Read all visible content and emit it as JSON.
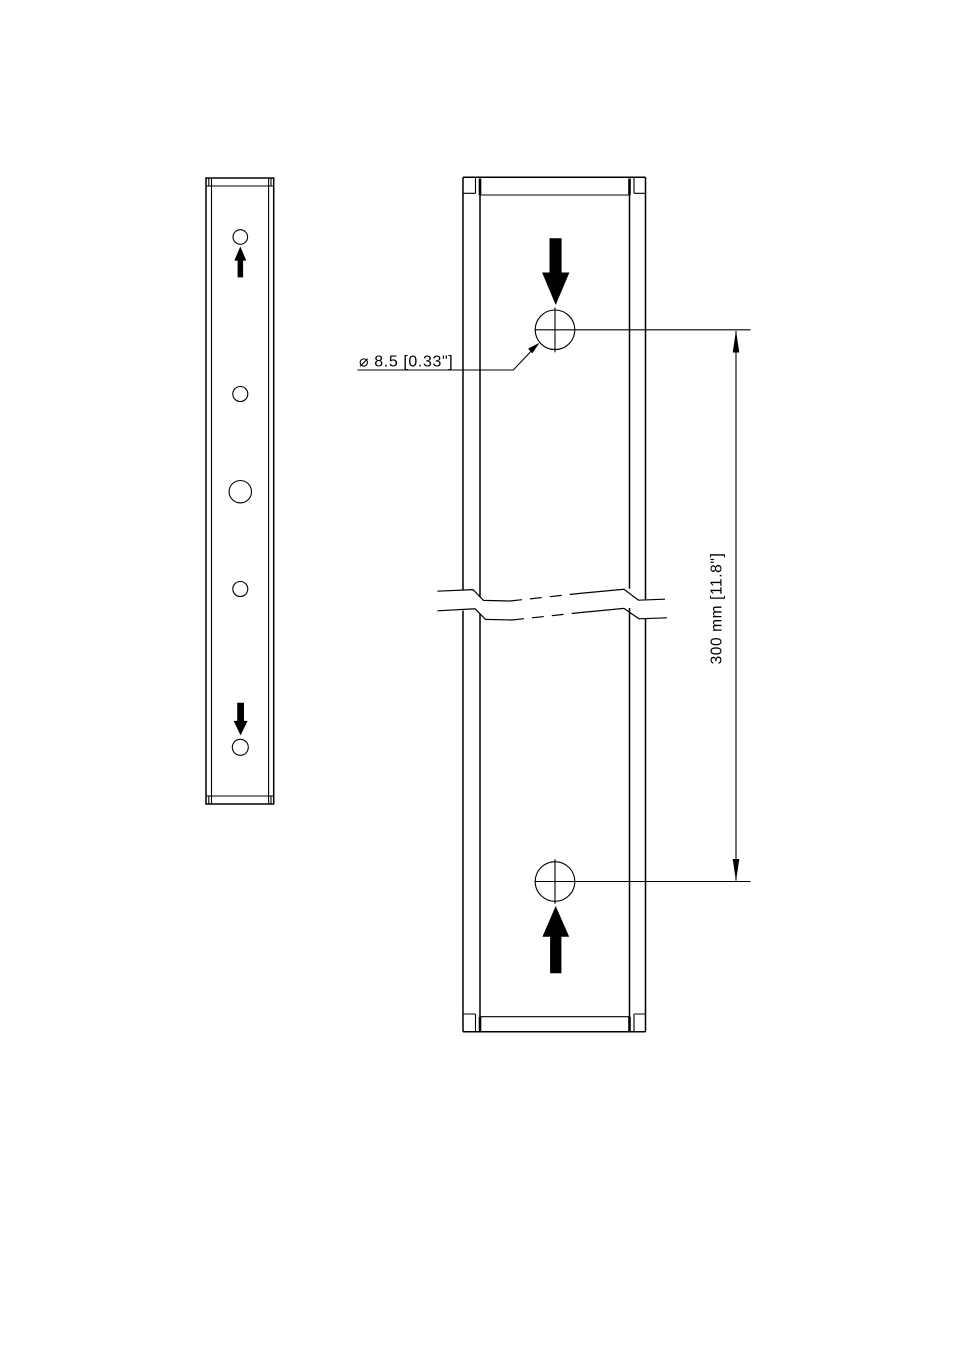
{
  "drawing": {
    "colors": {
      "background": "#ffffff",
      "line": "#000000"
    },
    "labels": {
      "hole_diameter": "⌀ 8.5 [0.33\"]",
      "hole_spacing": "300 mm [11.8\"]"
    },
    "icons": {
      "insert_direction_down_arrow": "▼",
      "insert_direction_up_arrow": "▲"
    }
  }
}
